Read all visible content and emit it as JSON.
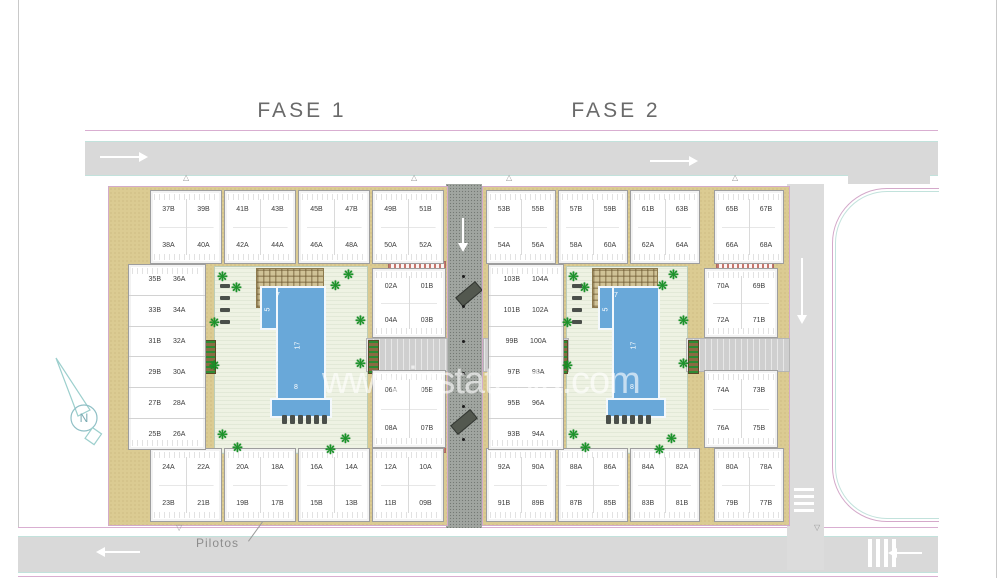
{
  "titles": {
    "fase1": "FASE 1",
    "fase2": "FASE 2"
  },
  "annotations": {
    "pilotos": "Pilotos",
    "watermark": "www.instatesta.com",
    "compass_letter": "N"
  },
  "icons": {
    "tree": "❋",
    "tri_up": "△",
    "tri_down": "▽"
  },
  "pool_dims": {
    "top_width": "7",
    "side": "5",
    "length": "17",
    "bottom": "8"
  },
  "colors": {
    "road_gray": "#d9d9d9",
    "central_road": "#a0a5a0",
    "tan": "#dbcb92",
    "courtyard": "#eef2e3",
    "pool_blue": "#69a8d9",
    "boundary_pink": "#d4a9ca",
    "accent_teal": "#c2e2dc",
    "tree_green": "#189427",
    "title_gray": "#6a6a6a"
  },
  "roads": {
    "central_bollards_y": [
      275,
      305,
      340,
      372,
      405,
      438
    ]
  },
  "tree_fracs": [
    [
      0.02,
      0.02
    ],
    [
      0.11,
      0.08
    ],
    [
      0.85,
      0.01
    ],
    [
      0.76,
      0.07
    ],
    [
      -0.03,
      0.27
    ],
    [
      -0.03,
      0.5
    ],
    [
      0.93,
      0.26
    ],
    [
      0.93,
      0.49
    ],
    [
      0.02,
      0.87
    ],
    [
      0.12,
      0.94
    ],
    [
      0.83,
      0.89
    ],
    [
      0.73,
      0.95
    ]
  ],
  "compounds": [
    {
      "id": "fase1",
      "tan": [
        108,
        186,
        338,
        338
      ],
      "top_blocks": {
        "y": 190,
        "h": 74,
        "w": 72,
        "x": [
          150,
          224,
          298,
          372
        ],
        "units": [
          [
            "37B",
            "39B",
            "38A",
            "40A"
          ],
          [
            "41B",
            "43B",
            "42A",
            "44A"
          ],
          [
            "45B",
            "47B",
            "46A",
            "48A"
          ],
          [
            "49B",
            "51B",
            "50A",
            "52A"
          ]
        ]
      },
      "bottom_blocks": {
        "y": 448,
        "h": 74,
        "w": 72,
        "x": [
          150,
          224,
          298,
          372
        ],
        "units": [
          [
            "24A",
            "22A",
            "23B",
            "21B"
          ],
          [
            "20A",
            "18A",
            "19B",
            "17B"
          ],
          [
            "16A",
            "14A",
            "15B",
            "13B"
          ],
          [
            "12A",
            "10A",
            "11B",
            "09B"
          ]
        ]
      },
      "west_building": {
        "rect": [
          128,
          264,
          78,
          186
        ],
        "rows": [
          [
            "35B",
            "36A"
          ],
          [
            "33B",
            "34A"
          ],
          [
            "31B",
            "32A"
          ],
          [
            "29B",
            "30A"
          ],
          [
            "27B",
            "28A"
          ],
          [
            "25B",
            "26A"
          ]
        ]
      },
      "east_blocks": {
        "x": 372,
        "w": 74,
        "blocks": [
          {
            "y": 268,
            "h": 70,
            "units": [
              "02A",
              "01B",
              "04A",
              "03B"
            ]
          },
          {
            "y": 370,
            "h": 78,
            "units": [
              "06A",
              "05B",
              "08A",
              "07B"
            ]
          }
        ]
      },
      "courtyard": [
        214,
        266,
        152,
        186
      ],
      "pool": {
        "upper": [
          260,
          286,
          44,
          40
        ],
        "main": [
          276,
          286,
          46,
          112
        ],
        "lip": [
          270,
          398,
          58,
          16
        ]
      },
      "pergola": [
        256,
        268,
        66,
        38
      ],
      "canopies": [
        [
          388,
          261,
          56,
          8
        ],
        [
          388,
          443,
          56,
          8
        ]
      ],
      "trellises": [
        [
          205,
          340
        ],
        [
          368,
          340
        ]
      ],
      "corridors": [
        [
          366,
          338,
          80,
          32
        ]
      ],
      "loungers_bottom": [
        282,
        415
      ],
      "loungers_left": [
        220,
        284
      ],
      "tri_top_x": [
        183,
        411
      ],
      "tri_bottom_x": [
        176
      ]
    },
    {
      "id": "fase2",
      "tan": [
        482,
        186,
        306,
        338
      ],
      "top_blocks": {
        "y": 190,
        "h": 74,
        "w": 70,
        "x": [
          486,
          558,
          630,
          714
        ],
        "units": [
          [
            "53B",
            "55B",
            "54A",
            "56A"
          ],
          [
            "57B",
            "59B",
            "58A",
            "60A"
          ],
          [
            "61B",
            "63B",
            "62A",
            "64A"
          ],
          [
            "65B",
            "67B",
            "66A",
            "68A"
          ]
        ]
      },
      "bottom_blocks": {
        "y": 448,
        "h": 74,
        "w": 70,
        "x": [
          486,
          558,
          630,
          714
        ],
        "units": [
          [
            "92A",
            "90A",
            "91B",
            "89B"
          ],
          [
            "88A",
            "86A",
            "87B",
            "85B"
          ],
          [
            "84A",
            "82A",
            "83B",
            "81B"
          ],
          [
            "80A",
            "78A",
            "79B",
            "77B"
          ]
        ]
      },
      "west_building": {
        "rect": [
          488,
          264,
          76,
          186
        ],
        "rows": [
          [
            "103B",
            "104A"
          ],
          [
            "101B",
            "102A"
          ],
          [
            "99B",
            "100A"
          ],
          [
            "97B",
            "98A"
          ],
          [
            "95B",
            "96A"
          ],
          [
            "93B",
            "94A"
          ]
        ]
      },
      "east_blocks": {
        "x": 704,
        "w": 74,
        "blocks": [
          {
            "y": 268,
            "h": 70,
            "units": [
              "70A",
              "69B",
              "72A",
              "71B"
            ]
          },
          {
            "y": 370,
            "h": 78,
            "units": [
              "74A",
              "73B",
              "76A",
              "75B"
            ]
          }
        ]
      },
      "courtyard": [
        566,
        266,
        120,
        186
      ],
      "pool": {
        "upper": [
          598,
          286,
          42,
          40
        ],
        "main": [
          612,
          286,
          44,
          112
        ],
        "lip": [
          606,
          398,
          56,
          16
        ]
      },
      "pergola": [
        592,
        268,
        64,
        38
      ],
      "canopies": [
        [
          716,
          261,
          56,
          8
        ],
        [
          716,
          443,
          56,
          8
        ]
      ],
      "trellises": [
        [
          557,
          340
        ],
        [
          688,
          340
        ]
      ],
      "corridors": [
        [
          483,
          338,
          84,
          32
        ],
        [
          686,
          338,
          102,
          32
        ]
      ],
      "loungers_bottom": [
        606,
        415
      ],
      "loungers_left": [
        572,
        284
      ],
      "tri_top_x": [
        506,
        732
      ],
      "tri_bottom_x": [
        814
      ]
    }
  ]
}
